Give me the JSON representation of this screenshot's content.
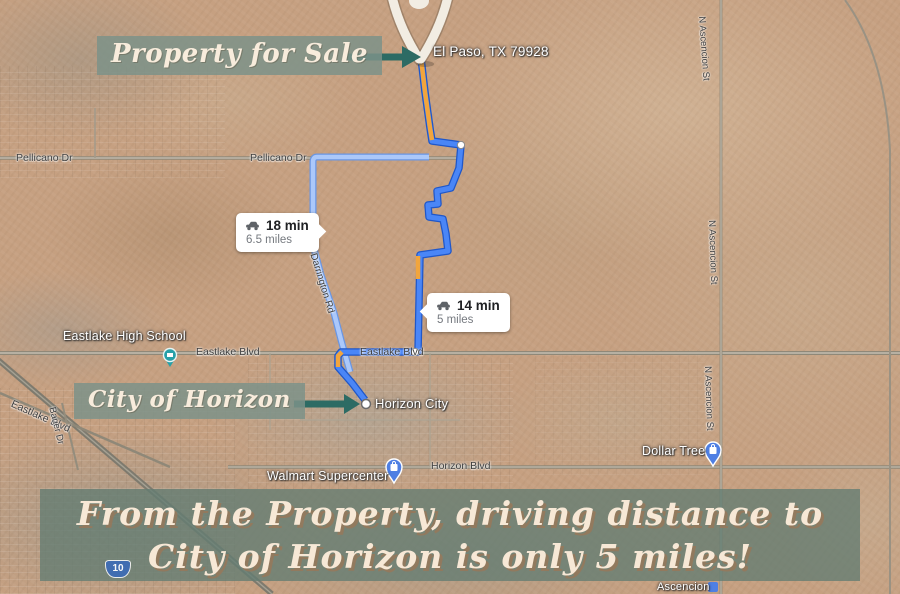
{
  "banners": {
    "property_label": "Property for Sale",
    "city_label": "City of Horizon",
    "footer_line1": "From the Property, driving distance to",
    "footer_line2": "City of Horizon is only 5 miles!"
  },
  "property_marker": {
    "address": "El Paso, TX 79928"
  },
  "directions": {
    "alternate_route": {
      "duration": "18 min",
      "distance": "6.5 miles"
    },
    "primary_route": {
      "duration": "14 min",
      "distance": "5 miles"
    }
  },
  "pois": {
    "horizon_city": "Horizon City",
    "eastlake_high_school": "Eastlake High School",
    "walmart_supercenter": "Walmart Supercenter",
    "dollar_tree": "Dollar Tree",
    "ascencion_store": "Ascencion"
  },
  "roads": {
    "pellicano_dr": "Pellicano Dr",
    "eastlake_blvd": "Eastlake Blvd",
    "horizon_blvd": "Horizon Blvd",
    "bauer_dr": "Bauer Dr",
    "darrington_rd": "Darrington Rd",
    "ascencion_st": "N Ascencion St",
    "interstate_10": "10"
  },
  "colors": {
    "banner_green": "#7d9288",
    "footer_green": "#637c72",
    "arrow_teal": "#2d6b64",
    "primary_route_blue": "#4a86f7",
    "alternate_route_blue": "#9bbdf9",
    "traffic_orange": "#f2a53d",
    "poi_pin_blue": "#4f7fe3",
    "school_pin_teal": "#27a0a8"
  }
}
